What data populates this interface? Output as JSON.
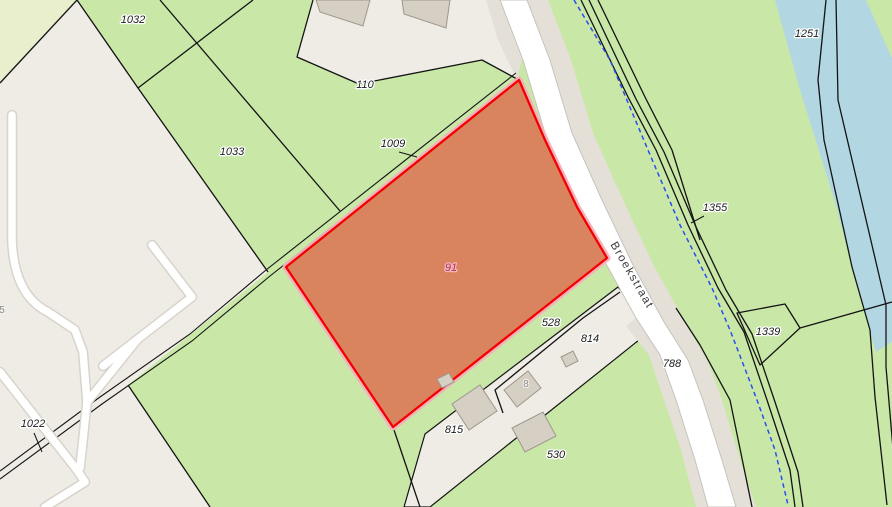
{
  "map": {
    "type": "cadastral-parcel-map",
    "street_label": {
      "text": "Broekstraat",
      "x": 629,
      "y": 277,
      "rotation": 60
    },
    "selected_parcel": {
      "number": "91",
      "label_x": 451,
      "label_y": 271,
      "fill": "#d9845f",
      "border_color": "#f40000",
      "glow_color": "#f5afbc",
      "label_color": "#b62e52"
    },
    "parcel_labels": [
      {
        "text": "1032",
        "x": 133,
        "y": 23
      },
      {
        "text": "110",
        "x": 365,
        "y": 88
      },
      {
        "text": "1033",
        "x": 232,
        "y": 155
      },
      {
        "text": "1009",
        "x": 393,
        "y": 147,
        "leader": [
          399,
          152,
          417,
          157
        ]
      },
      {
        "text": "1251",
        "x": 807,
        "y": 37
      },
      {
        "text": "1355",
        "x": 715,
        "y": 211,
        "leader": [
          704,
          216,
          691,
          223
        ]
      },
      {
        "text": "1339",
        "x": 768,
        "y": 335
      },
      {
        "text": "528",
        "x": 551,
        "y": 326
      },
      {
        "text": "814",
        "x": 590,
        "y": 342
      },
      {
        "text": "788",
        "x": 672,
        "y": 367
      },
      {
        "text": "815",
        "x": 454,
        "y": 433
      },
      {
        "text": "530",
        "x": 556,
        "y": 458
      },
      {
        "text": "1022",
        "x": 33,
        "y": 427,
        "leader": [
          34,
          433,
          42,
          452
        ]
      }
    ],
    "house_numbers": [
      {
        "text": "8",
        "x": 526,
        "y": 387
      },
      {
        "text": "5",
        "x": 2,
        "y": 313
      }
    ],
    "colors": {
      "grass_green": "#c9e7a7",
      "pale_field": "#e9efcc",
      "built_area_beige": "#efece5",
      "water_blue": "#b2d7e2",
      "road_white": "#ffffff",
      "road_shoulder": "#e4e0d7",
      "building_fill": "#d6cfc4",
      "parcel_line": "#141414",
      "boundary_dashed_blue": "#2a4df0",
      "parcel_label_text": "#1c1c1c",
      "house_number_text": "#8a8a8a"
    }
  }
}
